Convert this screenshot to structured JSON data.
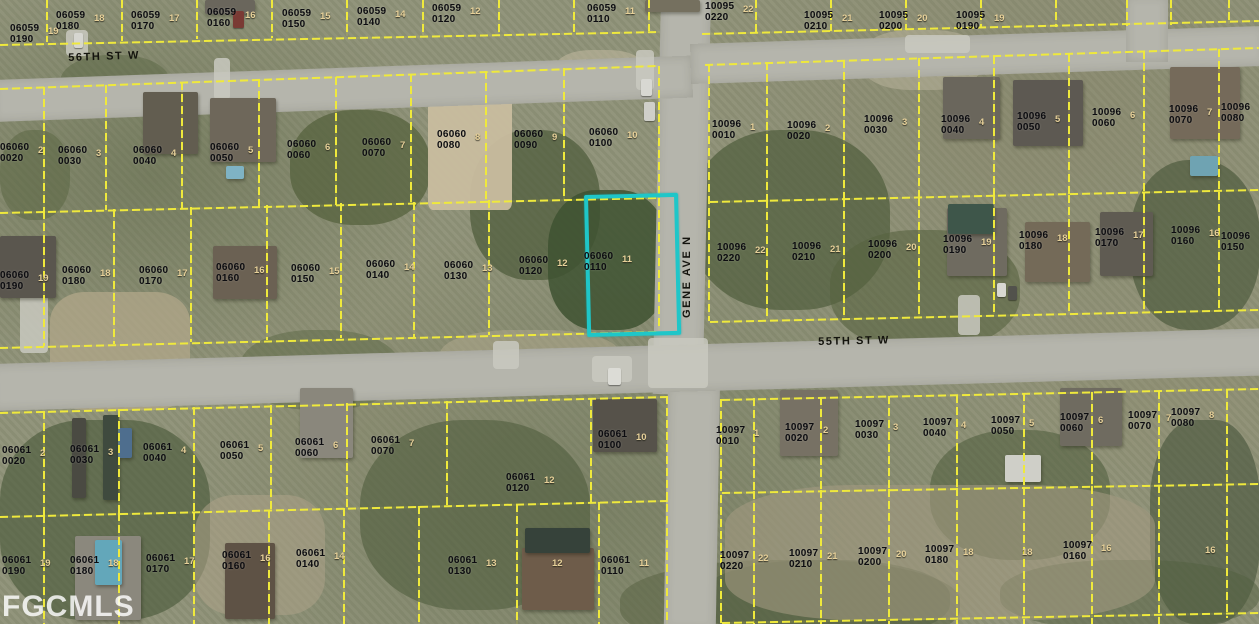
{
  "watermark": "FGCMLS",
  "map": {
    "street_names": [
      "56TH ST W",
      "55TH ST W",
      "GENE AVE N"
    ],
    "street_labels": [
      {
        "text": "56TH ST W",
        "x": 68,
        "y": 52,
        "rot": -2
      },
      {
        "text": "55TH ST W",
        "x": 818,
        "y": 336,
        "rot": -1.3
      },
      {
        "text": "GENE AVE N",
        "x": 681,
        "y": 318,
        "rot": -90
      }
    ],
    "roads": [
      {
        "name": "gene-ave-n",
        "x": 661,
        "y": -6,
        "w": 50,
        "h": 400,
        "rot": 1.2
      },
      {
        "name": "gene-ave-s",
        "x": 668,
        "y": 385,
        "w": 52,
        "h": 245,
        "rot": 1.0
      },
      {
        "name": "56th-st-w",
        "x": -8,
        "y": 80,
        "w": 700,
        "h": 42,
        "rot": -2.0
      },
      {
        "name": "ne-cross-st",
        "x": 690,
        "y": 44,
        "w": 575,
        "h": 40,
        "rot": -1.8
      },
      {
        "name": "55th-st-w",
        "x": -10,
        "y": 364,
        "w": 1285,
        "h": 47,
        "rot": -1.6
      },
      {
        "name": "ne-corner-stub",
        "x": 1126,
        "y": -4,
        "w": 42,
        "h": 66,
        "rot": 0
      }
    ],
    "highlight": {
      "parcel": "06060 0110",
      "x": 584,
      "y": 195,
      "w": 86,
      "h": 134,
      "rot": -1.3,
      "color": "#1fc6c8"
    },
    "patches": [
      [
        290,
        110,
        140,
        115,
        "#55613e",
        0.75,
        45
      ],
      [
        470,
        130,
        130,
        150,
        "#4c5a39",
        0.7,
        45
      ],
      [
        548,
        190,
        120,
        140,
        "#3e5231",
        0.85,
        40
      ],
      [
        690,
        130,
        200,
        180,
        "#4f5d3c",
        0.7,
        45
      ],
      [
        1130,
        160,
        130,
        170,
        "#4a583a",
        0.65,
        45
      ],
      [
        830,
        230,
        190,
        120,
        "#566240",
        0.6,
        45
      ],
      [
        0,
        420,
        210,
        200,
        "#4c5a3c",
        0.65,
        40
      ],
      [
        360,
        420,
        230,
        190,
        "#505e3e",
        0.6,
        45
      ],
      [
        620,
        560,
        340,
        90,
        "#55603f",
        0.5,
        45
      ],
      [
        930,
        430,
        180,
        130,
        "#4d5b3b",
        0.55,
        45
      ],
      [
        1150,
        420,
        110,
        204,
        "#46543a",
        0.6,
        40
      ],
      [
        60,
        55,
        110,
        60,
        "#5a6644",
        0.5,
        45
      ],
      [
        240,
        330,
        160,
        80,
        "#5c6845",
        0.5,
        45
      ],
      [
        700,
        560,
        250,
        80,
        "#4e5c3d",
        0.5,
        45
      ],
      [
        1000,
        560,
        259,
        70,
        "#52603f",
        0.5,
        45
      ],
      [
        0,
        130,
        70,
        90,
        "#57643f",
        0.5,
        45
      ],
      [
        428,
        76,
        84,
        134,
        "#c9bd9f",
        0.95,
        6
      ],
      [
        50,
        292,
        140,
        118,
        "#b2a78a",
        0.75,
        25
      ],
      [
        725,
        485,
        430,
        135,
        "#a29a80",
        0.6,
        30
      ],
      [
        195,
        495,
        130,
        120,
        "#ada289",
        0.55,
        30
      ],
      [
        555,
        50,
        90,
        45,
        "#bdb69c",
        0.6,
        40
      ],
      [
        862,
        30,
        120,
        60,
        "#b8b29a",
        0.55,
        40
      ],
      [
        440,
        330,
        180,
        60,
        "#b1aa8e",
        0.5,
        40
      ]
    ],
    "paving": [
      [
        66,
        30,
        22,
        26
      ],
      [
        214,
        58,
        16,
        42
      ],
      [
        20,
        295,
        28,
        58
      ],
      [
        958,
        295,
        22,
        40
      ],
      [
        493,
        341,
        26,
        28
      ],
      [
        592,
        356,
        40,
        26
      ],
      [
        905,
        35,
        65,
        18
      ],
      [
        636,
        50,
        18,
        40
      ],
      [
        648,
        338,
        60,
        50
      ]
    ],
    "houses": [
      [
        143,
        92,
        55,
        62,
        "#625d50"
      ],
      [
        210,
        98,
        66,
        64,
        "#6e675a"
      ],
      [
        943,
        77,
        57,
        62,
        "#6a665c"
      ],
      [
        1013,
        80,
        70,
        66,
        "#5d5952"
      ],
      [
        1170,
        67,
        70,
        72,
        "#756a5a"
      ],
      [
        0,
        236,
        56,
        62,
        "#5a564e"
      ],
      [
        213,
        246,
        64,
        53,
        "#6b6153"
      ],
      [
        947,
        208,
        60,
        68,
        "#6f6b60"
      ],
      [
        1025,
        222,
        65,
        60,
        "#746a58"
      ],
      [
        1100,
        212,
        53,
        64,
        "#5f5b52"
      ],
      [
        300,
        388,
        53,
        70,
        "#8a877c"
      ],
      [
        780,
        390,
        58,
        66,
        "#777164"
      ],
      [
        1060,
        388,
        62,
        58,
        "#6f6b60"
      ],
      [
        75,
        536,
        66,
        84,
        "#8b887d"
      ],
      [
        225,
        543,
        50,
        76,
        "#5e5245"
      ],
      [
        522,
        548,
        72,
        62,
        "#6e5c4a"
      ],
      [
        525,
        528,
        65,
        25,
        "#36423a"
      ],
      [
        593,
        399,
        64,
        53,
        "#56524a"
      ],
      [
        205,
        0,
        50,
        14,
        "#6a665c"
      ],
      [
        645,
        0,
        55,
        12,
        "#75705f"
      ],
      [
        226,
        166,
        18,
        13,
        "#7fb3c4"
      ],
      [
        95,
        540,
        27,
        45,
        "#63a7ba"
      ],
      [
        948,
        204,
        46,
        30,
        "#3e564a"
      ],
      [
        1190,
        156,
        28,
        20,
        "#6fa3b2"
      ],
      [
        1005,
        455,
        36,
        27,
        "#cfcfc8"
      ],
      [
        72,
        418,
        14,
        80,
        "#4a4a42"
      ],
      [
        103,
        415,
        16,
        85,
        "#3f4a3e"
      ],
      [
        118,
        428,
        14,
        30,
        "#4e6e8e"
      ]
    ],
    "cars": [
      [
        641,
        79,
        11,
        17,
        "#d8d8d2"
      ],
      [
        644,
        102,
        11,
        19,
        "#cfcfc9"
      ],
      [
        997,
        283,
        9,
        14,
        "#d8d8d2"
      ],
      [
        1008,
        286,
        9,
        14,
        "#52524c"
      ],
      [
        608,
        368,
        13,
        17,
        "#dcdcd6"
      ],
      [
        74,
        33,
        9,
        15,
        "#d6d6d0"
      ],
      [
        233,
        11,
        11,
        17,
        "#7a3a34"
      ]
    ],
    "parcel_lines": [
      [
        0,
        44,
        660,
        31
      ],
      [
        702,
        33,
        1259,
        20
      ],
      [
        0,
        88,
        658,
        65
      ],
      [
        705,
        64,
        1259,
        47
      ],
      [
        0,
        212,
        658,
        197
      ],
      [
        710,
        201,
        1259,
        189
      ],
      [
        0,
        347,
        658,
        331
      ],
      [
        710,
        321,
        1259,
        309
      ],
      [
        0,
        412,
        668,
        396
      ],
      [
        722,
        399,
        1259,
        388
      ],
      [
        0,
        516,
        668,
        500
      ],
      [
        722,
        492,
        1259,
        483
      ],
      [
        722,
        622,
        1259,
        612
      ],
      [
        48,
        0,
        48,
        42
      ],
      [
        123,
        0,
        123,
        41
      ],
      [
        198,
        0,
        198,
        39
      ],
      [
        273,
        0,
        273,
        38
      ],
      [
        348,
        0,
        348,
        36
      ],
      [
        424,
        0,
        424,
        35
      ],
      [
        500,
        0,
        500,
        33
      ],
      [
        575,
        0,
        575,
        32
      ],
      [
        650,
        0,
        650,
        31
      ],
      [
        757,
        0,
        757,
        32
      ],
      [
        832,
        0,
        832,
        31
      ],
      [
        907,
        0,
        907,
        30
      ],
      [
        982,
        0,
        982,
        28
      ],
      [
        1057,
        0,
        1057,
        27
      ],
      [
        1128,
        0,
        1128,
        26
      ],
      [
        1172,
        0,
        1172,
        25
      ],
      [
        1230,
        0,
        1230,
        24
      ],
      [
        660,
        66,
        660,
        330
      ],
      [
        45,
        87,
        45,
        211
      ],
      [
        107,
        85,
        107,
        210
      ],
      [
        183,
        82,
        183,
        209
      ],
      [
        260,
        79,
        260,
        207
      ],
      [
        337,
        77,
        337,
        205
      ],
      [
        412,
        74,
        412,
        204
      ],
      [
        487,
        71,
        487,
        202
      ],
      [
        565,
        68,
        565,
        200
      ],
      [
        45,
        211,
        45,
        346
      ],
      [
        115,
        209,
        115,
        344
      ],
      [
        192,
        207,
        192,
        342
      ],
      [
        268,
        205,
        268,
        340
      ],
      [
        342,
        203,
        342,
        338
      ],
      [
        415,
        202,
        415,
        337
      ],
      [
        490,
        200,
        490,
        335
      ],
      [
        710,
        64,
        710,
        321
      ],
      [
        768,
        62,
        768,
        200
      ],
      [
        845,
        60,
        845,
        199
      ],
      [
        920,
        58,
        920,
        198
      ],
      [
        995,
        56,
        995,
        196
      ],
      [
        1070,
        54,
        1070,
        195
      ],
      [
        1145,
        51,
        1145,
        193
      ],
      [
        1220,
        49,
        1220,
        192
      ],
      [
        768,
        200,
        768,
        319
      ],
      [
        845,
        199,
        845,
        317
      ],
      [
        920,
        198,
        920,
        316
      ],
      [
        995,
        196,
        995,
        314
      ],
      [
        1070,
        195,
        1070,
        313
      ],
      [
        1145,
        193,
        1145,
        312
      ],
      [
        1220,
        192,
        1220,
        310
      ],
      [
        668,
        396,
        668,
        624
      ],
      [
        45,
        411,
        45,
        515
      ],
      [
        120,
        409,
        120,
        513
      ],
      [
        195,
        407,
        195,
        512
      ],
      [
        272,
        405,
        272,
        510
      ],
      [
        348,
        403,
        348,
        508
      ],
      [
        448,
        401,
        448,
        506
      ],
      [
        592,
        398,
        592,
        503
      ],
      [
        45,
        515,
        45,
        624
      ],
      [
        120,
        513,
        120,
        624
      ],
      [
        195,
        512,
        195,
        624
      ],
      [
        270,
        510,
        270,
        624
      ],
      [
        345,
        508,
        345,
        624
      ],
      [
        420,
        506,
        420,
        624
      ],
      [
        518,
        504,
        518,
        624
      ],
      [
        600,
        502,
        600,
        624
      ],
      [
        722,
        399,
        722,
        624
      ],
      [
        755,
        398,
        755,
        491
      ],
      [
        822,
        397,
        822,
        490
      ],
      [
        890,
        396,
        890,
        489
      ],
      [
        958,
        395,
        958,
        488
      ],
      [
        1025,
        393,
        1025,
        487
      ],
      [
        1093,
        392,
        1093,
        486
      ],
      [
        1160,
        391,
        1160,
        485
      ],
      [
        1228,
        390,
        1228,
        484
      ],
      [
        755,
        491,
        755,
        624
      ],
      [
        822,
        490,
        822,
        624
      ],
      [
        890,
        489,
        890,
        624
      ],
      [
        958,
        488,
        958,
        624
      ],
      [
        1025,
        487,
        1025,
        624
      ],
      [
        1093,
        486,
        1093,
        624
      ],
      [
        1160,
        485,
        1160,
        624
      ],
      [
        1228,
        484,
        1228,
        618
      ]
    ],
    "parcels": [
      [
        "06059 0190",
        10,
        24
      ],
      [
        "06059 0180",
        56,
        11
      ],
      [
        "06059 0170",
        131,
        11
      ],
      [
        "06059 0160",
        207,
        8
      ],
      [
        "06059 0150",
        282,
        9
      ],
      [
        "06059 0140",
        357,
        7
      ],
      [
        "06059 0120",
        432,
        4
      ],
      [
        "06059 0110",
        587,
        4
      ],
      [
        "10095 0220",
        705,
        2
      ],
      [
        "10095 0210",
        804,
        11
      ],
      [
        "10095 0200",
        879,
        11
      ],
      [
        "10095 0190",
        956,
        11
      ],
      [
        "06060 0020",
        0,
        143
      ],
      [
        "06060 0030",
        58,
        146
      ],
      [
        "06060 0040",
        133,
        146
      ],
      [
        "06060 0050",
        210,
        143
      ],
      [
        "06060 0060",
        287,
        140
      ],
      [
        "06060 0070",
        362,
        138
      ],
      [
        "06060 0080",
        437,
        130
      ],
      [
        "06060 0090",
        514,
        130
      ],
      [
        "06060 0100",
        589,
        128
      ],
      [
        "06060 0190",
        0,
        271
      ],
      [
        "06060 0180",
        62,
        266
      ],
      [
        "06060 0170",
        139,
        266
      ],
      [
        "06060 0160",
        216,
        263
      ],
      [
        "06060 0150",
        291,
        264
      ],
      [
        "06060 0140",
        366,
        260
      ],
      [
        "06060 0130",
        444,
        261
      ],
      [
        "06060 0120",
        519,
        256
      ],
      [
        "06060 0110",
        584,
        252
      ],
      [
        "10096 0010",
        712,
        120
      ],
      [
        "10096 0020",
        787,
        121
      ],
      [
        "10096 0030",
        864,
        115
      ],
      [
        "10096 0040",
        941,
        115
      ],
      [
        "10096 0050",
        1017,
        112
      ],
      [
        "10096 0060",
        1092,
        108
      ],
      [
        "10096 0070",
        1169,
        105
      ],
      [
        "10096 0080",
        1221,
        103
      ],
      [
        "10096 0220",
        717,
        243
      ],
      [
        "10096 0210",
        792,
        242
      ],
      [
        "10096 0200",
        868,
        240
      ],
      [
        "10096 0190",
        943,
        235
      ],
      [
        "10096 0180",
        1019,
        231
      ],
      [
        "10096 0170",
        1095,
        228
      ],
      [
        "10096 0160",
        1171,
        226
      ],
      [
        "10096 0150",
        1221,
        232
      ],
      [
        "06061 0020",
        2,
        446
      ],
      [
        "06061 0030",
        70,
        445
      ],
      [
        "06061 0040",
        143,
        443
      ],
      [
        "06061 0050",
        220,
        441
      ],
      [
        "06061 0060",
        295,
        438
      ],
      [
        "06061 0070",
        371,
        436
      ],
      [
        "06061 0100",
        598,
        430
      ],
      [
        "06061 0120",
        506,
        473
      ],
      [
        "06061 0190",
        2,
        556
      ],
      [
        "06061 0180",
        70,
        556
      ],
      [
        "06061 0170",
        146,
        554
      ],
      [
        "06061 0160",
        222,
        551
      ],
      [
        "06061 0140",
        296,
        549
      ],
      [
        "06061 0130",
        448,
        556
      ],
      [
        "06061 0110",
        601,
        556
      ],
      [
        "10097 0010",
        716,
        426
      ],
      [
        "10097 0020",
        785,
        423
      ],
      [
        "10097 0030",
        855,
        420
      ],
      [
        "10097 0040",
        923,
        418
      ],
      [
        "10097 0050",
        991,
        416
      ],
      [
        "10097 0060",
        1060,
        413
      ],
      [
        "10097 0070",
        1128,
        411
      ],
      [
        "10097 0080",
        1171,
        408
      ],
      [
        "10097 0220",
        720,
        551
      ],
      [
        "10097 0210",
        789,
        549
      ],
      [
        "10097 0200",
        858,
        547
      ],
      [
        "10097 0180",
        925,
        545
      ],
      [
        "10097 0160",
        1063,
        541
      ]
    ],
    "extra_lot_numbers": [
      [
        "18",
        1022,
        547
      ],
      [
        "16",
        1205,
        545
      ],
      [
        "12",
        552,
        558
      ]
    ],
    "line_color": "#efe93c",
    "label_color": "#0c0c10",
    "lot_color": "#e6d099"
  }
}
